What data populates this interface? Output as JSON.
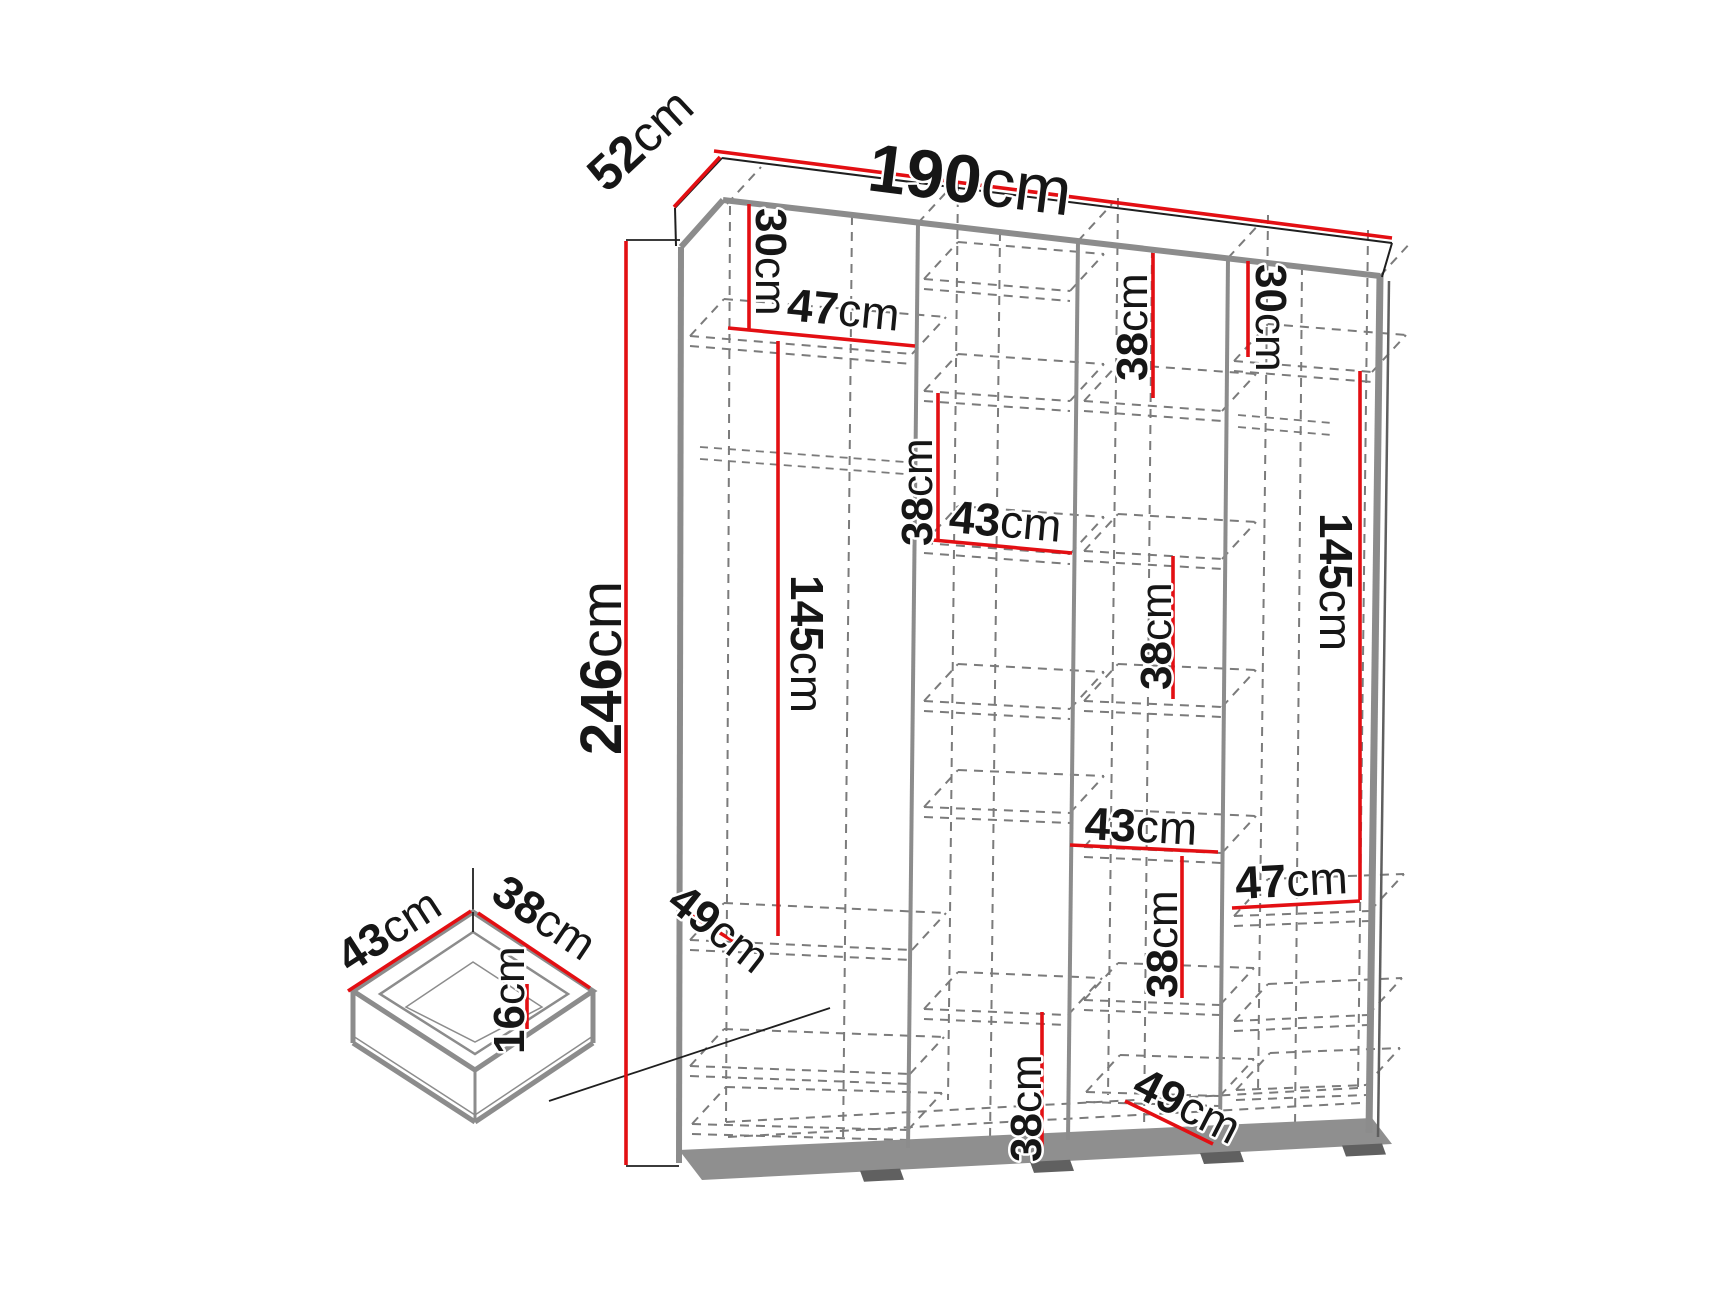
{
  "diagram": {
    "type": "furniture-dimension-diagram",
    "subject": "wardrobe-with-drawer",
    "unit": "cm",
    "colors": {
      "dimension_line": "#e30f13",
      "outline_gray": "#8c8c8c",
      "outline_dark": "#5f5f5f",
      "dashed_gray": "#7b7b7b",
      "thin_black": "#1f1f1f",
      "text": "#161616",
      "background": "#ffffff"
    },
    "overall": {
      "width_cm": 190,
      "depth_cm": 52,
      "height_cm": 246
    },
    "drawer": {
      "width_cm": 43,
      "depth_cm": 38,
      "height_cm": 16
    },
    "dimensions": [
      {
        "id": "width-190",
        "value": "190",
        "unit": "cm",
        "line": [
          714,
          151,
          1392,
          238
        ],
        "label": {
          "x": 866,
          "y": 190,
          "rot": 7.2,
          "size": 68,
          "anchor": "start"
        }
      },
      {
        "id": "depth-52",
        "value": "52",
        "unit": "cm",
        "line": [
          674,
          207,
          720,
          157
        ],
        "label": {
          "x": 607,
          "y": 194,
          "rot": -43,
          "size": 50,
          "anchor": "start"
        }
      },
      {
        "id": "height-246",
        "value": "246",
        "unit": "cm",
        "line": [
          626,
          241,
          626,
          1165
        ],
        "label": {
          "x": 621,
          "y": 668,
          "rot": -90,
          "size": 58,
          "anchor": "middle"
        }
      },
      {
        "id": "col1-top-30",
        "value": "30",
        "unit": "cm",
        "line": [
          749,
          204,
          749,
          330
        ],
        "label": {
          "x": 756,
          "y": 208,
          "rot": 90,
          "size": 44,
          "anchor": "start"
        }
      },
      {
        "id": "col1-width-47",
        "value": "47",
        "unit": "cm",
        "line": [
          728,
          328,
          915,
          346
        ],
        "label": {
          "x": 786,
          "y": 320,
          "rot": 5.5,
          "size": 46,
          "anchor": "start"
        }
      },
      {
        "id": "col1-145",
        "value": "145",
        "unit": "cm",
        "line": [
          778,
          341,
          778,
          936
        ],
        "label": {
          "x": 791,
          "y": 575,
          "rot": 90,
          "size": 46,
          "anchor": "start"
        }
      },
      {
        "id": "col1-depth-49",
        "value": "49",
        "unit": "cm",
        "line": [
          683,
          910,
          733,
          941
        ],
        "label": {
          "x": 665,
          "y": 906,
          "rot": 38,
          "size": 46,
          "anchor": "start"
        }
      },
      {
        "id": "col2-38-top",
        "value": "38",
        "unit": "cm",
        "line": [
          938,
          393,
          938,
          540
        ],
        "label": {
          "x": 932,
          "y": 546,
          "rot": -90,
          "size": 44,
          "anchor": "start"
        }
      },
      {
        "id": "col2-width-43",
        "value": "43",
        "unit": "cm",
        "line": [
          922,
          539,
          1072,
          553
        ],
        "label": {
          "x": 948,
          "y": 532,
          "rot": 5,
          "size": 46,
          "anchor": "start"
        }
      },
      {
        "id": "col2-38-bottom",
        "value": "38",
        "unit": "cm",
        "line": [
          1042,
          1012,
          1042,
          1148
        ],
        "label": {
          "x": 1041,
          "y": 1162,
          "rot": -90,
          "size": 44,
          "anchor": "start"
        }
      },
      {
        "id": "col3-38-top",
        "value": "38",
        "unit": "cm",
        "line": [
          1153,
          253,
          1153,
          398
        ],
        "label": {
          "x": 1147,
          "y": 381,
          "rot": -90,
          "size": 44,
          "anchor": "start"
        }
      },
      {
        "id": "col3-38-mid",
        "value": "38",
        "unit": "cm",
        "line": [
          1173,
          556,
          1173,
          699
        ],
        "label": {
          "x": 1171,
          "y": 690,
          "rot": -90,
          "size": 44,
          "anchor": "start"
        }
      },
      {
        "id": "col3-width-43",
        "value": "43",
        "unit": "cm",
        "line": [
          1070,
          845,
          1218,
          852
        ],
        "label": {
          "x": 1084,
          "y": 839,
          "rot": 3,
          "size": 46,
          "anchor": "start"
        }
      },
      {
        "id": "col3-38-low",
        "value": "38",
        "unit": "cm",
        "line": [
          1182,
          856,
          1182,
          998
        ],
        "label": {
          "x": 1177,
          "y": 998,
          "rot": -90,
          "size": 44,
          "anchor": "start"
        }
      },
      {
        "id": "col3-depth-49",
        "value": "49",
        "unit": "cm",
        "line": [
          1125,
          1101,
          1213,
          1144
        ],
        "label": {
          "x": 1130,
          "y": 1094,
          "rot": 27,
          "size": 46,
          "anchor": "start"
        }
      },
      {
        "id": "col4-top-30",
        "value": "30",
        "unit": "cm",
        "line": [
          1248,
          261,
          1248,
          357
        ],
        "label": {
          "x": 1256,
          "y": 264,
          "rot": 90,
          "size": 44,
          "anchor": "start"
        }
      },
      {
        "id": "col4-145",
        "value": "145",
        "unit": "cm",
        "line": [
          1360,
          371,
          1360,
          900
        ],
        "label": {
          "x": 1320,
          "y": 513,
          "rot": 90,
          "size": 46,
          "anchor": "start"
        }
      },
      {
        "id": "col4-width-47",
        "value": "47",
        "unit": "cm",
        "line": [
          1232,
          908,
          1360,
          901
        ],
        "label": {
          "x": 1236,
          "y": 899,
          "rot": -3,
          "size": 46,
          "anchor": "start"
        }
      },
      {
        "id": "drawer-width-43",
        "value": "43",
        "unit": "cm",
        "line": [
          348,
          991,
          471,
          911
        ],
        "label": {
          "x": 350,
          "y": 974,
          "rot": -33,
          "size": 46,
          "anchor": "start"
        }
      },
      {
        "id": "drawer-depth-38",
        "value": "38",
        "unit": "cm",
        "line": [
          478,
          913,
          590,
          988
        ],
        "label": {
          "x": 489,
          "y": 899,
          "rot": 34,
          "size": 46,
          "anchor": "start"
        }
      },
      {
        "id": "drawer-height-16",
        "value": "16",
        "unit": "cm",
        "line": [
          527,
          984,
          527,
          1029
        ],
        "label": {
          "x": 524,
          "y": 1054,
          "rot": -90,
          "size": 44,
          "anchor": "start"
        }
      }
    ]
  }
}
